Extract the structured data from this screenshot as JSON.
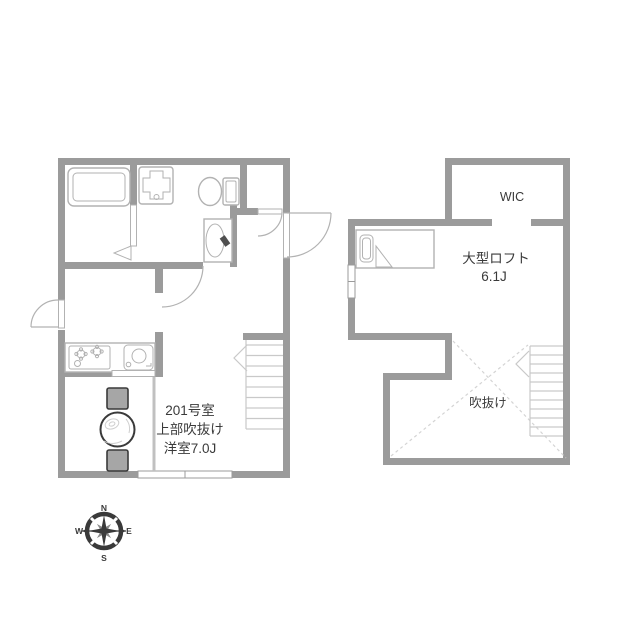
{
  "first_floor": {
    "room_label": {
      "line1": "201号室",
      "line2": "上部吹抜け",
      "line3": "洋室7.0J"
    }
  },
  "loft_floor": {
    "wic_label": "WIC",
    "loft_label": {
      "line1": "大型ロフト",
      "line2": "6.1J"
    },
    "void_label": "吹抜け"
  },
  "compass": {
    "north": "N",
    "east": "E",
    "south": "S",
    "west": "W"
  },
  "colors": {
    "wall": "#9b9b9b",
    "fixture": "#b2b2b2",
    "stair": "#c9c9c9",
    "void_dash": "#d4d4d4",
    "grain": "#cfcfcf",
    "chair_fill": "#a6a6a6",
    "dark": "#3a3a3a",
    "text": "#3a3a3a",
    "boundary": "#c0c0c0"
  }
}
